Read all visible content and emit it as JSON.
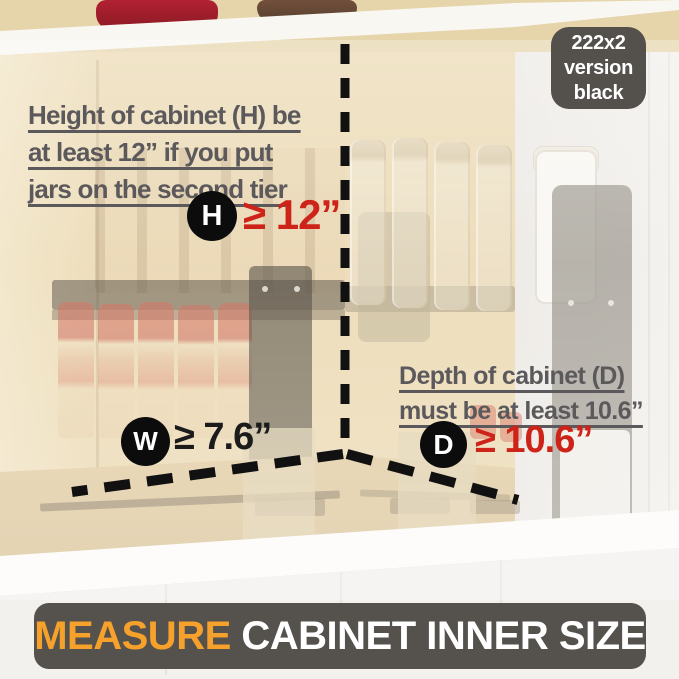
{
  "badge": {
    "lines": [
      "222x2",
      "version",
      "black"
    ]
  },
  "height_note": {
    "lines": [
      "Height of cabinet (H) be",
      "at least 12” if you put",
      "jars on the second tier"
    ]
  },
  "depth_note": {
    "lines": [
      "Depth of cabinet (D)",
      "must be at least 10.6”"
    ]
  },
  "markers": {
    "height": {
      "letter": "H",
      "value": "≥ 12”",
      "value_color": "#cd2318"
    },
    "width": {
      "letter": "W",
      "value": "≥ 7.6”",
      "value_color": "#1b1b1b"
    },
    "depth": {
      "letter": "D",
      "value": "≥ 10.6”",
      "value_color": "#cd2318"
    }
  },
  "banner": {
    "highlight": "MEASURE",
    "rest": " CABINET INNER SIZE",
    "highlight_color": "#f5a12b"
  },
  "colors": {
    "accent_red": "#cd2318",
    "note_gray": "#5b595b",
    "dash_black": "#111111",
    "badge_bg": "#54504c",
    "banner_bg": "#55514d",
    "banner_orange": "#f5a12b",
    "wood_tan": "#ebd9b2"
  }
}
